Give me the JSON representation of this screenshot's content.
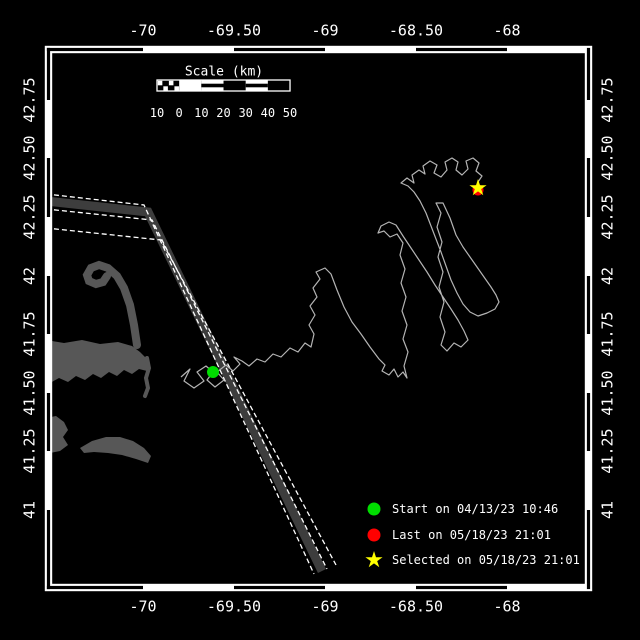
{
  "colors": {
    "background": "#000000",
    "frame": "#ffffff",
    "land": "#575757",
    "lane_zone": "#3d3d3d",
    "lane_line": "#ffffff",
    "track": "#b4b4b4",
    "start_marker": "#00dd00",
    "last_marker": "#ff0000",
    "selected_marker": "#ffff00",
    "text": "#ffffff"
  },
  "axes": {
    "lon": {
      "labels": [
        "-70",
        "-69.50",
        "-69",
        "-68.50",
        "-68"
      ],
      "x": [
        143,
        234,
        325,
        416,
        507
      ]
    },
    "lat": {
      "labels": [
        "42.75",
        "42.50",
        "42.25",
        "42",
        "41.75",
        "41.50",
        "41.25",
        "41"
      ],
      "y": [
        100,
        158,
        217,
        276,
        334,
        393,
        451,
        510
      ]
    }
  },
  "frame": {
    "x0": 45.5,
    "y0": 46.5,
    "x1": 591.5,
    "y1": 590.5,
    "inset": 6
  },
  "scalebar": {
    "title": "Scale (km)",
    "title_x": 224,
    "title_y": 72,
    "tick_labels": [
      "10",
      "0",
      "10",
      "20",
      "30",
      "40",
      "50"
    ],
    "bar_x": 157,
    "bar_y": 80,
    "bar_h": 11,
    "step": 22.17,
    "labels_y": 113,
    "segment_styles": [
      "hatched",
      "solid",
      "striped",
      "outline",
      "striped",
      "outline"
    ]
  },
  "legend": {
    "items": [
      {
        "marker": "circle",
        "color": "#00dd00",
        "label": "Start on 04/13/23 10:46",
        "mx": 374,
        "my": 509
      },
      {
        "marker": "circle",
        "color": "#ff0000",
        "label": "Last on 05/18/23 21:01",
        "mx": 374,
        "my": 535
      },
      {
        "marker": "star",
        "color": "#ffff00",
        "label": "Selected on 05/18/23 21:01",
        "mx": 374,
        "my": 560
      }
    ],
    "text_x": 392
  },
  "markers": {
    "start": {
      "x": 213,
      "y": 372,
      "r": 6
    },
    "last": {
      "x": 478,
      "y": 190,
      "r": 5.5
    },
    "selected": {
      "x": 478,
      "y": 188,
      "R": 9,
      "r": 3.4
    }
  },
  "map": {
    "land_fills": [
      [
        [
          46,
          340
        ],
        [
          64,
          343
        ],
        [
          82,
          340
        ],
        [
          100,
          344
        ],
        [
          118,
          342
        ],
        [
          132,
          346
        ],
        [
          140,
          352
        ],
        [
          146,
          358
        ],
        [
          150,
          364
        ],
        [
          147,
          371
        ],
        [
          139,
          369
        ],
        [
          132,
          374
        ],
        [
          124,
          370
        ],
        [
          117,
          376
        ],
        [
          109,
          372
        ],
        [
          101,
          378
        ],
        [
          93,
          374
        ],
        [
          85,
          380
        ],
        [
          76,
          376
        ],
        [
          68,
          382
        ],
        [
          59,
          378
        ],
        [
          50,
          383
        ],
        [
          46,
          381
        ]
      ],
      [
        [
          46,
          418
        ],
        [
          56,
          416
        ],
        [
          64,
          422
        ],
        [
          68,
          430
        ],
        [
          63,
          437
        ],
        [
          68,
          445
        ],
        [
          60,
          451
        ],
        [
          50,
          453
        ],
        [
          46,
          450
        ]
      ],
      [
        [
          80,
          448
        ],
        [
          92,
          441
        ],
        [
          106,
          437
        ],
        [
          120,
          437
        ],
        [
          133,
          441
        ],
        [
          144,
          448
        ],
        [
          151,
          456
        ],
        [
          148,
          463
        ],
        [
          136,
          459
        ],
        [
          122,
          455
        ],
        [
          108,
          453
        ],
        [
          94,
          452
        ],
        [
          84,
          453
        ]
      ]
    ],
    "land_strokes": [
      {
        "w": 8,
        "pts": [
          [
            137,
            345
          ],
          [
            134,
            325
          ],
          [
            130,
            305
          ],
          [
            124,
            288
          ],
          [
            117,
            276
          ],
          [
            108,
            268
          ],
          [
            99,
            265
          ],
          [
            91,
            268
          ],
          [
            87,
            275
          ],
          [
            89,
            281
          ],
          [
            96,
            284
          ],
          [
            103,
            282
          ],
          [
            107,
            276
          ]
        ]
      },
      {
        "w": 4,
        "pts": [
          [
            147,
            358
          ],
          [
            149,
            368
          ],
          [
            146,
            378
          ],
          [
            148,
            388
          ],
          [
            145,
            396
          ]
        ]
      }
    ],
    "lane": {
      "band": [
        [
          46,
          201
        ],
        [
          148,
          212
        ],
        [
          322,
          571
        ]
      ],
      "band_w": 9,
      "lines": [
        [
          [
            46,
            194
          ],
          [
            144,
            205
          ],
          [
            314,
            574
          ]
        ],
        [
          [
            46,
            209
          ],
          [
            152,
            220
          ],
          [
            327,
            569
          ]
        ],
        [
          [
            46,
            228
          ],
          [
            161,
            240
          ],
          [
            336,
            565
          ]
        ]
      ]
    },
    "track_points": [
      [
        181,
        377
      ],
      [
        190,
        369
      ],
      [
        184,
        381
      ],
      [
        194,
        388
      ],
      [
        204,
        381
      ],
      [
        197,
        372
      ],
      [
        206,
        366
      ],
      [
        213,
        372
      ],
      [
        207,
        380
      ],
      [
        215,
        387
      ],
      [
        224,
        380
      ],
      [
        217,
        372
      ],
      [
        226,
        365
      ],
      [
        233,
        371
      ],
      [
        240,
        364
      ],
      [
        234,
        357
      ],
      [
        242,
        361
      ],
      [
        249,
        366
      ],
      [
        257,
        359
      ],
      [
        265,
        362
      ],
      [
        273,
        354
      ],
      [
        281,
        357
      ],
      [
        290,
        348
      ],
      [
        298,
        352
      ],
      [
        305,
        343
      ],
      [
        311,
        347
      ],
      [
        314,
        334
      ],
      [
        309,
        325
      ],
      [
        315,
        315
      ],
      [
        310,
        306
      ],
      [
        317,
        297
      ],
      [
        313,
        288
      ],
      [
        320,
        279
      ],
      [
        316,
        272
      ],
      [
        325,
        268
      ],
      [
        331,
        274
      ],
      [
        337,
        290
      ],
      [
        344,
        307
      ],
      [
        352,
        322
      ],
      [
        361,
        334
      ],
      [
        370,
        347
      ],
      [
        379,
        359
      ],
      [
        385,
        365
      ],
      [
        382,
        371
      ],
      [
        389,
        375
      ],
      [
        394,
        369
      ],
      [
        398,
        377
      ],
      [
        403,
        372
      ],
      [
        407,
        378
      ],
      [
        404,
        366
      ],
      [
        408,
        352
      ],
      [
        403,
        339
      ],
      [
        407,
        325
      ],
      [
        402,
        311
      ],
      [
        406,
        297
      ],
      [
        401,
        283
      ],
      [
        405,
        269
      ],
      [
        400,
        255
      ],
      [
        403,
        243
      ],
      [
        397,
        234
      ],
      [
        390,
        237
      ],
      [
        384,
        231
      ],
      [
        378,
        233
      ],
      [
        381,
        226
      ],
      [
        389,
        222
      ],
      [
        396,
        225
      ],
      [
        403,
        236
      ],
      [
        411,
        248
      ],
      [
        419,
        260
      ],
      [
        427,
        272
      ],
      [
        435,
        285
      ],
      [
        443,
        297
      ],
      [
        451,
        309
      ],
      [
        458,
        320
      ],
      [
        464,
        331
      ],
      [
        468,
        340
      ],
      [
        461,
        347
      ],
      [
        454,
        343
      ],
      [
        447,
        351
      ],
      [
        441,
        345
      ],
      [
        445,
        332
      ],
      [
        440,
        317
      ],
      [
        444,
        302
      ],
      [
        439,
        287
      ],
      [
        443,
        272
      ],
      [
        438,
        257
      ],
      [
        442,
        242
      ],
      [
        437,
        227
      ],
      [
        441,
        213
      ],
      [
        436,
        203
      ],
      [
        443,
        203
      ],
      [
        450,
        218
      ],
      [
        456,
        235
      ],
      [
        463,
        247
      ],
      [
        470,
        257
      ],
      [
        477,
        267
      ],
      [
        484,
        277
      ],
      [
        491,
        287
      ],
      [
        496,
        295
      ],
      [
        499,
        302
      ],
      [
        495,
        309
      ],
      [
        487,
        313
      ],
      [
        478,
        316
      ],
      [
        470,
        312
      ],
      [
        463,
        304
      ],
      [
        457,
        293
      ],
      [
        451,
        280
      ],
      [
        446,
        266
      ],
      [
        441,
        252
      ],
      [
        436,
        239
      ],
      [
        431,
        226
      ],
      [
        426,
        213
      ],
      [
        420,
        201
      ],
      [
        414,
        192
      ],
      [
        408,
        186
      ],
      [
        401,
        183
      ],
      [
        407,
        178
      ],
      [
        414,
        183
      ],
      [
        412,
        175
      ],
      [
        419,
        170
      ],
      [
        425,
        174
      ],
      [
        423,
        166
      ],
      [
        430,
        161
      ],
      [
        437,
        165
      ],
      [
        434,
        173
      ],
      [
        441,
        177
      ],
      [
        447,
        170
      ],
      [
        445,
        162
      ],
      [
        452,
        158
      ],
      [
        458,
        162
      ],
      [
        456,
        170
      ],
      [
        462,
        175
      ],
      [
        468,
        169
      ],
      [
        466,
        161
      ],
      [
        473,
        158
      ],
      [
        479,
        163
      ],
      [
        476,
        171
      ],
      [
        482,
        176
      ],
      [
        478,
        182
      ],
      [
        478,
        188
      ]
    ]
  }
}
